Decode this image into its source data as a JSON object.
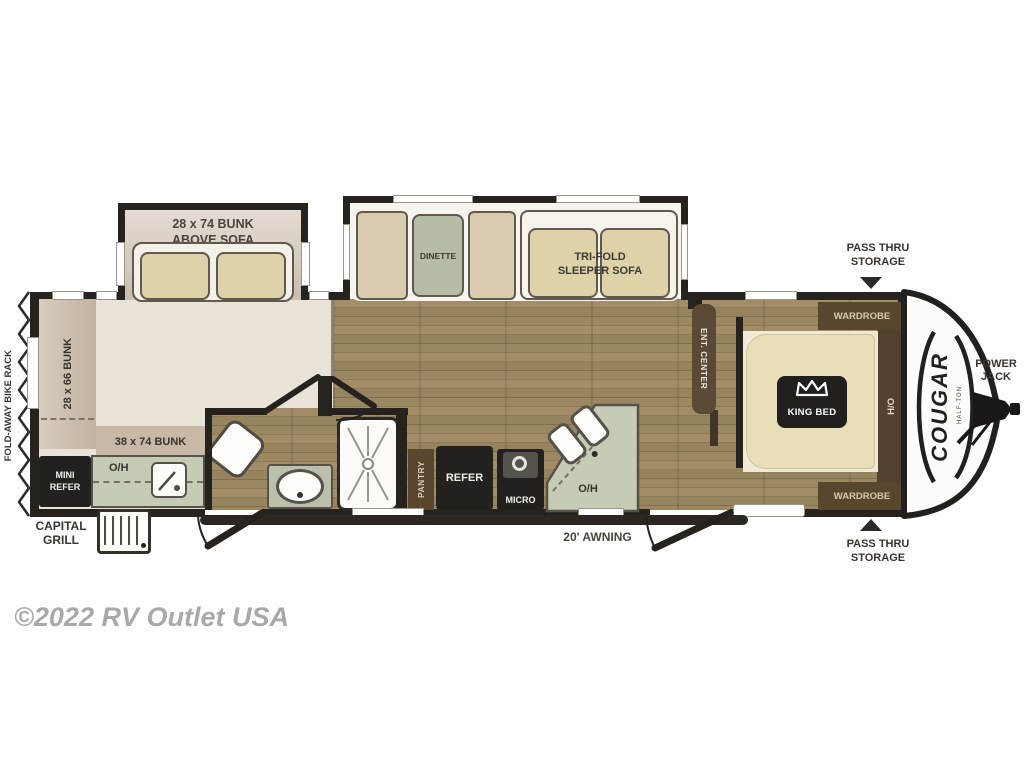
{
  "watermark": "©2022 RV Outlet USA",
  "brand": {
    "model": "COUGAR",
    "series": "HALF-TON"
  },
  "exterior": {
    "bike_rack": "FOLD-AWAY BIKE RACK",
    "grill_l1": "CAPITAL",
    "grill_l2": "GRILL",
    "pass_thru_l1": "PASS THRU",
    "pass_thru_l2": "STORAGE",
    "power_jack_l1": "POWER",
    "power_jack_l2": "JACK",
    "awning": "20' AWNING"
  },
  "interior": {
    "bunk_sofa_l1": "28 x 74 BUNK",
    "bunk_sofa_l2": "ABOVE SOFA",
    "bunk_side": "28 x 66 BUNK",
    "bunk_bottom": "38 x 74 BUNK",
    "dinette": "DINETTE",
    "sofa_l1": "TRI-FOLD",
    "sofa_l2": "SLEEPER SOFA",
    "mini_refer_l1": "MINI",
    "mini_refer_l2": "REFER",
    "oh_rear": "O/H",
    "oh_kitchen": "O/H",
    "pantry": "PANTRY",
    "refer": "REFER",
    "micro": "MICRO",
    "ent_center": "ENT. CENTER",
    "king_bed": "KING BED",
    "wardrobe_top": "WARDROBE",
    "wardrobe_bottom": "WARDROBE",
    "ho": "H/O"
  },
  "palette": {
    "wall": "#26231f",
    "wood_floor": "#98835f",
    "bunkroom_floor": "#e8e2d7",
    "counter_green": "#c5cbb4",
    "cushion_tan": "#ddd2a8",
    "bed_tan": "#e9deba",
    "cabinet_brown": "#58462f",
    "appliance_dark": "#23211e",
    "cap_white": "#fcfcf9",
    "watermark_gray": "#a9a9ac"
  }
}
